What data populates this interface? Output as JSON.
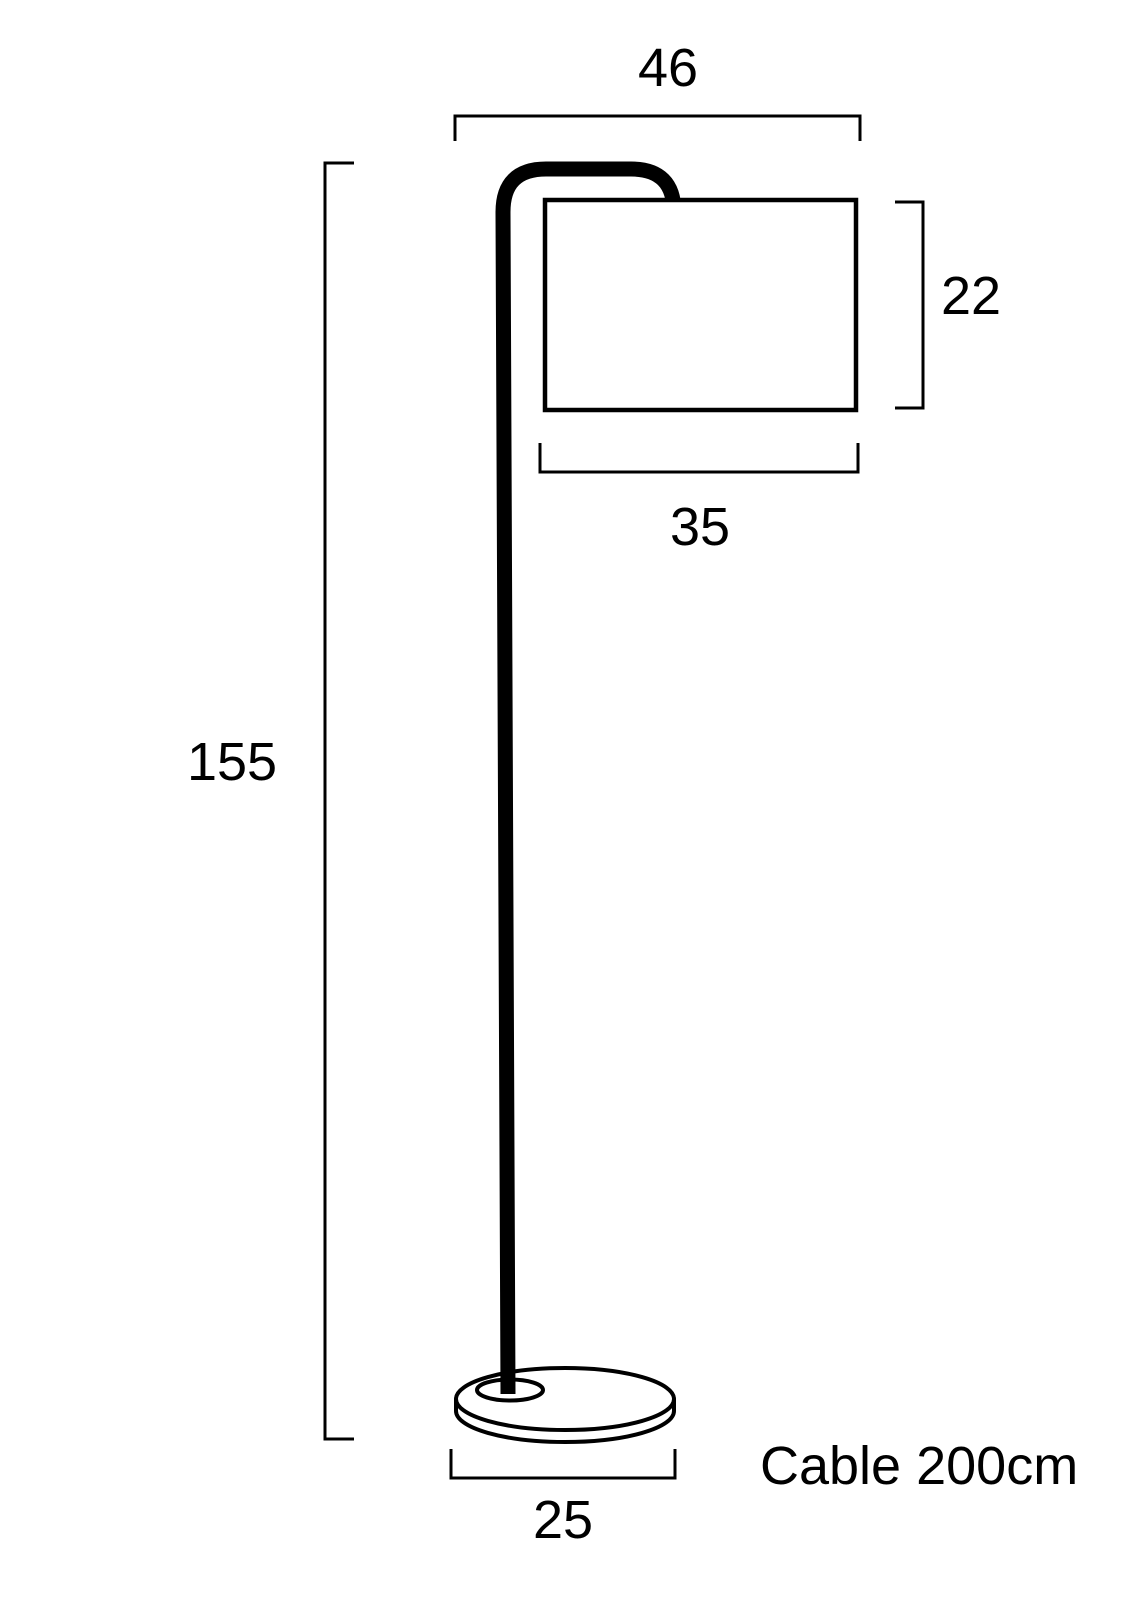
{
  "diagram": {
    "subject": "floor-lamp-technical-dimension-drawing",
    "labels": {
      "top_width": "46",
      "shade_height": "22",
      "shade_width": "35",
      "total_height": "155",
      "base_width": "25",
      "cable_note": "Cable 200cm"
    },
    "colors": {
      "line": "#000000",
      "background": "#ffffff"
    }
  }
}
